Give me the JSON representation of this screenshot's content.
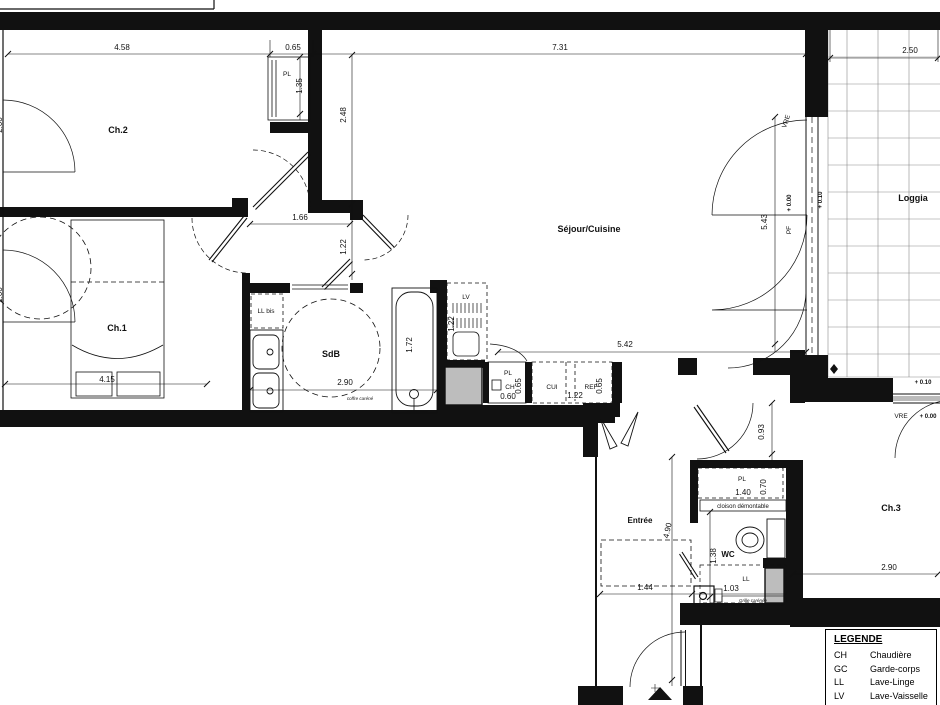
{
  "colors": {
    "wall": "#111111",
    "duct": "#bdbdbd",
    "grid": "#8a8a8a"
  },
  "rooms": {
    "ch2": "Ch.2",
    "ch1": "Ch.1",
    "sdb": "SdB",
    "sejour": "Séjour/Cuisine",
    "loggia": "Loggia",
    "entree": "Entrée",
    "wc": "WC",
    "ch3": "Ch.3"
  },
  "dims": {
    "top_458": "4.58",
    "top_065": "0.65",
    "top_731": "7.31",
    "top_250": "2.50",
    "v135": "1.35",
    "v248": "2.48",
    "d166": "1.66",
    "v122_hall": "1.22",
    "v543": "5.43",
    "d415": "4.15",
    "sdb_290": "2.90",
    "v172": "1.72",
    "v122_lv": "1.22",
    "d060": "0.60",
    "v065_ch": "0.65",
    "k122": "1.22",
    "v065_ref": "0.65",
    "d542": "5.42",
    "v093": "0.93",
    "d140": "1.40",
    "v070": "0.70",
    "v490": "4.90",
    "v138": "1.38",
    "d103": "1.03",
    "d144": "1.44",
    "ch3_290": "2.90",
    "edge_a": "2.00",
    "edge_b": "2.00"
  },
  "labels": {
    "pl_ch2": "PL",
    "ll_bis": "LL bis",
    "lv": "LV",
    "pl_kitchen": "PL",
    "ch_kitchen": "CH",
    "cui": "CUI",
    "ref": "REF",
    "vre_loggia": "VRE",
    "pf": "PF",
    "lvl_000_window": "+ 0.00",
    "lvl_010_loggia": "+ 0.10",
    "lvl_010_ch3": "+ 0.10",
    "vre_ch3": "VRE",
    "lvl_000_ch3": "+ 0.00",
    "pl_wc": "PL",
    "cloison": "cloison démontable",
    "ll_wc": "LL",
    "coffre": "coffre caréné",
    "grille": "Grille carénée"
  },
  "legend": {
    "title": "LEGENDE",
    "entries": [
      {
        "abbr": "CH",
        "label": "Chaudière"
      },
      {
        "abbr": "GC",
        "label": "Garde-corps"
      },
      {
        "abbr": "LL",
        "label": "Lave-Linge"
      },
      {
        "abbr": "LV",
        "label": "Lave-Vaisselle"
      },
      {
        "abbr": "CUI",
        "label": "Cuisson"
      }
    ]
  }
}
